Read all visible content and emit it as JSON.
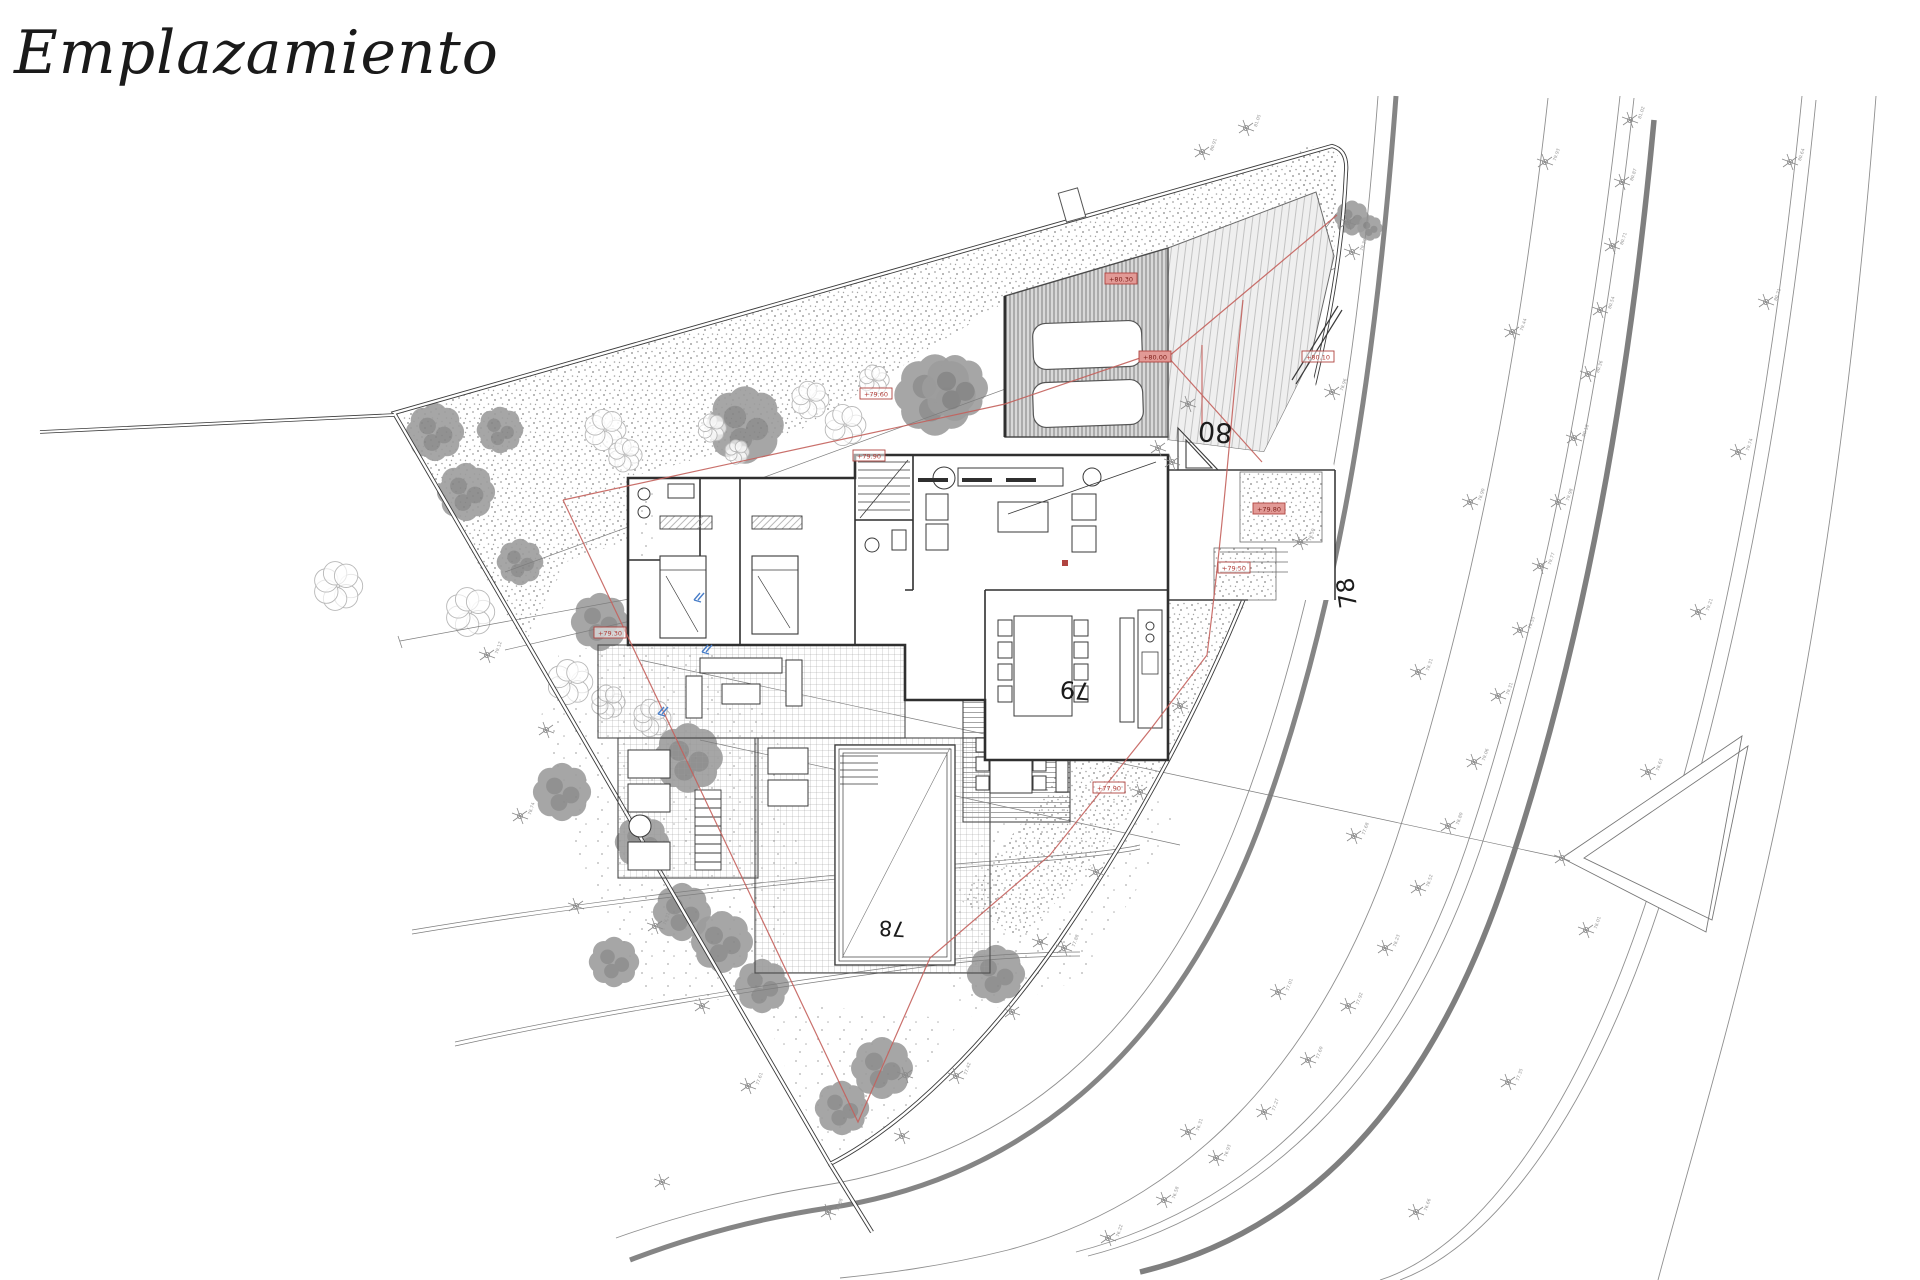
{
  "page": {
    "title": "Emplazamiento"
  },
  "colors": {
    "ink": "#2f2f2f",
    "contour": "#8f8f8f",
    "road_edge": "#858585",
    "red_line": "#c4615c",
    "red_label_fill": "#e29a96",
    "red_label_stroke": "#b04440",
    "red_label_text": "#7c1d18",
    "tree_dark": "#9d9d9d",
    "tree_dark2": "#868686",
    "tree_light": "#b8b8b8",
    "stipple": "#a3a3a3",
    "blue_mark": "#4a7fc9"
  },
  "elevation_labels": [
    {
      "text": "80",
      "x": 1233,
      "y": 424,
      "rot": 184,
      "size": 27
    },
    {
      "text": "79",
      "x": 1091,
      "y": 683,
      "rot": 184,
      "size": 24
    },
    {
      "text": "78",
      "x": 906,
      "y": 922,
      "rot": 183,
      "size": 21
    },
    {
      "text": "78",
      "x": 1357,
      "y": 607,
      "rot": 262,
      "size": 24
    }
  ],
  "red_labels": [
    {
      "text": "+80.30",
      "x": 1121,
      "y": 279,
      "style": "filled"
    },
    {
      "text": "+80.00",
      "x": 1155,
      "y": 357,
      "style": "filled"
    },
    {
      "text": "+79.80",
      "x": 1269,
      "y": 509,
      "style": "filled"
    },
    {
      "text": "+80.10",
      "x": 1318,
      "y": 357,
      "style": "outline"
    },
    {
      "text": "+79.60",
      "x": 876,
      "y": 394,
      "style": "outline"
    },
    {
      "text": "+79.30",
      "x": 610,
      "y": 633,
      "style": "outline"
    },
    {
      "text": "+77.90",
      "x": 1109,
      "y": 788,
      "style": "outline"
    },
    {
      "text": "+79.50",
      "x": 1234,
      "y": 568,
      "style": "outline"
    },
    {
      "text": "+79.90",
      "x": 869,
      "y": 456,
      "style": "outline"
    },
    {
      "text": "",
      "x": 1065,
      "y": 563,
      "style": "dot"
    }
  ],
  "survey_markers": [
    [
      1630,
      120,
      "81.02"
    ],
    [
      1622,
      182,
      "80.87"
    ],
    [
      1612,
      246,
      "80.71"
    ],
    [
      1600,
      310,
      "80.54"
    ],
    [
      1588,
      374,
      "80.36"
    ],
    [
      1574,
      438,
      "80.18"
    ],
    [
      1558,
      502,
      "79.98"
    ],
    [
      1540,
      566,
      "79.77"
    ],
    [
      1520,
      630,
      "79.55"
    ],
    [
      1498,
      696,
      "79.31"
    ],
    [
      1474,
      762,
      "79.06"
    ],
    [
      1448,
      826,
      "78.80"
    ],
    [
      1418,
      888,
      "78.52"
    ],
    [
      1385,
      948,
      "78.23"
    ],
    [
      1348,
      1006,
      "77.92"
    ],
    [
      1308,
      1060,
      "77.60"
    ],
    [
      1264,
      1112,
      "77.27"
    ],
    [
      1216,
      1158,
      "76.93"
    ],
    [
      1164,
      1200,
      "76.58"
    ],
    [
      1108,
      1238,
      "76.22"
    ],
    [
      1790,
      162,
      "80.64"
    ],
    [
      1766,
      302,
      "80.21"
    ],
    [
      1738,
      452,
      "79.74"
    ],
    [
      1698,
      612,
      "79.21"
    ],
    [
      1648,
      772,
      "78.63"
    ],
    [
      1586,
      930,
      "78.01"
    ],
    [
      1508,
      1082,
      "77.35"
    ],
    [
      1416,
      1212,
      "76.66"
    ],
    [
      1545,
      162,
      "79.93"
    ],
    [
      1512,
      332,
      "79.44"
    ],
    [
      1470,
      502,
      "78.90"
    ],
    [
      1418,
      672,
      "78.31"
    ],
    [
      1354,
      836,
      "77.68"
    ],
    [
      1278,
      992,
      "77.01"
    ],
    [
      1188,
      1132,
      "76.31"
    ],
    [
      1352,
      252,
      "79.38"
    ],
    [
      1332,
      392,
      "78.96"
    ],
    [
      1300,
      542,
      "78.50"
    ],
    [
      1202,
      152,
      "80.91"
    ],
    [
      1246,
      128,
      "81.05"
    ],
    [
      1348,
      222,
      ""
    ],
    [
      1158,
      448,
      ""
    ],
    [
      1172,
      462,
      ""
    ],
    [
      1188,
      404,
      ""
    ],
    [
      487,
      655,
      "79.12"
    ],
    [
      546,
      730,
      ""
    ],
    [
      520,
      816,
      "78.74"
    ],
    [
      576,
      906,
      ""
    ],
    [
      655,
      926,
      "78.31"
    ],
    [
      702,
      1006,
      ""
    ],
    [
      748,
      1086,
      "77.61"
    ],
    [
      662,
      1182,
      ""
    ],
    [
      828,
      1212,
      "76.88"
    ],
    [
      902,
      1136,
      ""
    ],
    [
      956,
      1076,
      "77.42"
    ],
    [
      1012,
      1012,
      ""
    ],
    [
      1064,
      948,
      "77.88"
    ],
    [
      1180,
      706,
      ""
    ],
    [
      1140,
      792,
      ""
    ],
    [
      1096,
      872,
      ""
    ],
    [
      1040,
      942,
      ""
    ],
    [
      905,
      1075,
      ""
    ],
    [
      1562,
      858,
      ""
    ]
  ],
  "trees": {
    "dark": [
      [
        435,
        432,
        30
      ],
      [
        466,
        492,
        30
      ],
      [
        520,
        562,
        24
      ],
      [
        500,
        430,
        24
      ],
      [
        745,
        425,
        40
      ],
      [
        935,
        395,
        42
      ],
      [
        955,
        388,
        34
      ],
      [
        1040,
        522,
        26
      ],
      [
        600,
        622,
        30
      ],
      [
        688,
        758,
        36
      ],
      [
        562,
        792,
        30
      ],
      [
        642,
        842,
        28
      ],
      [
        682,
        912,
        30
      ],
      [
        614,
        962,
        26
      ],
      [
        722,
        942,
        32
      ],
      [
        762,
        986,
        28
      ],
      [
        882,
        1068,
        32
      ],
      [
        996,
        974,
        30
      ],
      [
        842,
        1108,
        28
      ],
      [
        1270,
        506,
        26
      ],
      [
        1352,
        218,
        18
      ],
      [
        1370,
        228,
        13
      ]
    ],
    "light": [
      [
        338,
        586,
        26
      ],
      [
        470,
        612,
        26
      ],
      [
        605,
        430,
        22
      ],
      [
        625,
        455,
        18
      ],
      [
        712,
        428,
        15
      ],
      [
        737,
        452,
        13
      ],
      [
        810,
        400,
        20
      ],
      [
        845,
        425,
        22
      ],
      [
        874,
        380,
        16
      ],
      [
        570,
        682,
        24
      ],
      [
        608,
        702,
        18
      ],
      [
        652,
        718,
        20
      ],
      [
        1233,
        556,
        13
      ],
      [
        1232,
        584,
        11
      ],
      [
        990,
        570,
        16
      ],
      [
        1005,
        592,
        14
      ]
    ]
  },
  "blue_marks": [
    [
      694,
      600
    ],
    [
      702,
      652
    ],
    [
      658,
      714
    ]
  ]
}
